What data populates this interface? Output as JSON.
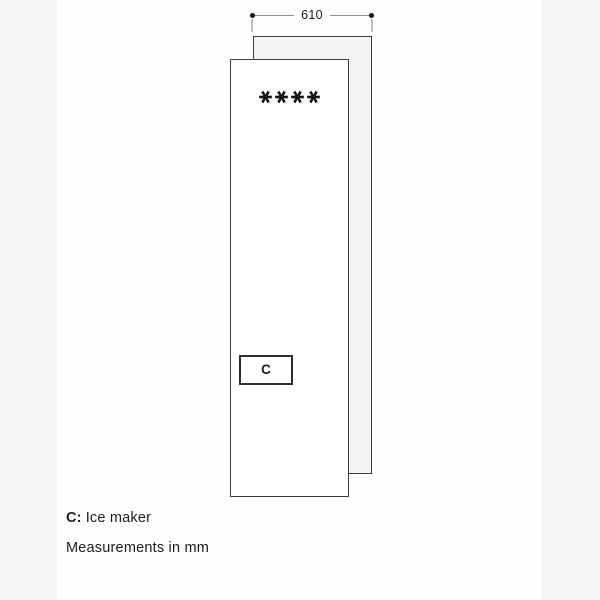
{
  "diagram": {
    "dimension": {
      "width_label": "610"
    },
    "star_count": 4,
    "star_symbol": "*",
    "compartment": {
      "label": "C"
    },
    "legend": {
      "key": "C:",
      "value": "Ice maker",
      "note": "Measurements in mm"
    }
  },
  "colors": {
    "page_background": "#f5f5f5",
    "content_background": "#fefefe",
    "back_panel_fill": "#f3f3f3",
    "front_panel_fill": "#ffffff",
    "panel_border": "#3f3f3f",
    "dimension_line": "#8c8c8c",
    "extension_line": "#bdbdbd",
    "text": "#1a1a1a"
  }
}
